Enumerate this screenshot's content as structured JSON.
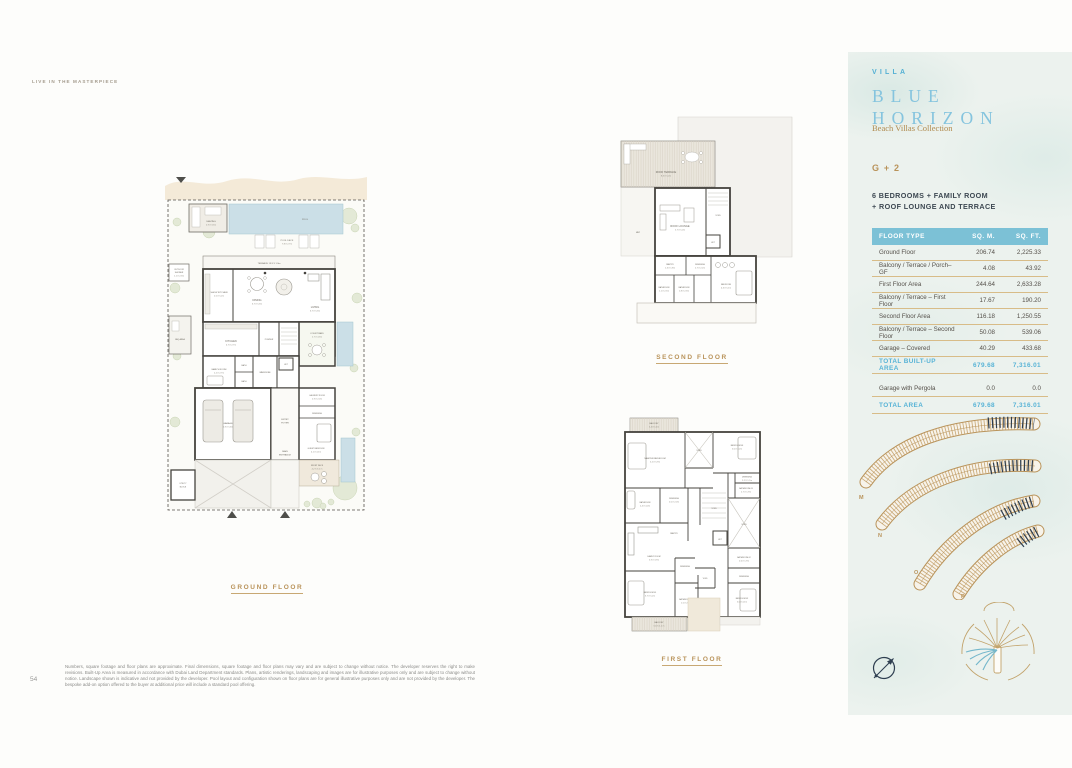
{
  "page": {
    "eyebrow": "LIVE IN THE MASTERPIECE",
    "page_number": "54",
    "disclaimer": "Numbers, square footage and floor plans are approximate. Final dimensions, square footage and floor plans may vary and are subject to change without notice. The developer reserves the right to make revisions. Built-Up Area is measured in accordance with Dubai Land Department standards. Plans, artistic renderings, landscaping and images are for illustrative purposes only and are subject to change without notice. Landscape shown is indicative and not provided by the developer. Pool layout and configuration shown on floor plans are for general illustrative purposes only and are not provided by the developer. The bespoke add-on option offered to the buyer at additional price will include a standard pool offering."
  },
  "plans": {
    "ground": {
      "caption": "GROUND FLOOR",
      "rooms": {
        "seating": "SEATING",
        "seating_dim": "2.9 X 3.5m",
        "pool": "POOL",
        "pool_deck": "POOL DECK",
        "pool_deck_dim": "7.8 X 2.7m",
        "terrace": "TERRACE 13.9 X 1.9m",
        "outdoor_shower_1": "OUTDOOR",
        "outdoor_shower_2": "SHOWER",
        "outdoor_shower_dim": "1.1 X 2.3m",
        "show_kitchen": "SHOW KITCHEN",
        "show_kitchen_dim": "2.5 X 5.2m",
        "dining": "DINING",
        "dining_dim": "6.7 X 5.3m",
        "living": "LIVING",
        "living_dim": "6.7 X 5.3m",
        "bbq": "BBQ AREA",
        "kitchen": "KITCHEN",
        "kitchen_dim": "4.7 X 2.7m",
        "powder": "POWDER",
        "courtyard": "COURTYARD",
        "courtyard_dim": "2.7 X 4.3m",
        "maids": "MAID'S ROOM",
        "maids_dim": "2.2 X 2.7m",
        "bath_a": "BATH",
        "bath_b": "BATH",
        "wardrobe": "WARDROBE",
        "lift": "LIFT",
        "garage": "GARAGE",
        "garage_dim": "5.9 X 5.6m",
        "entry_1": "ENTRY",
        "entry_2": "FOYER",
        "main_entrance_1": "MAIN",
        "main_entrance_2": "ENTRANCE",
        "laundry": "LAUNDRY ROOM",
        "laundry_dim": "2.9 X 2.0m",
        "dressing": "DRESSING",
        "guest_bedroom": "GUEST BEDROOM",
        "guest_bedroom_dim": "4.1 X 4.1m",
        "front_deck": "FRONT DECK",
        "front_deck_dim": "4.2 X 3.1 m",
        "utility_1": "UTILITY",
        "utility_2": "BLOCK"
      }
    },
    "second": {
      "caption": "SECOND FLOOR",
      "rooms": {
        "roof_terrace": "ROOF TERRACE",
        "roof_terrace_dim": "8.3 X 5.2m",
        "roof_lounge": "ROOF LOUNGE",
        "roof_lounge_dim": "5.7 X 5.0m",
        "void": "VOID",
        "lift": "LIFT",
        "mep": "MEP",
        "pantry": "PANTRY",
        "pantry_dim": "1.3 X 1.8m",
        "dressing": "DRESSING",
        "dressing_dim": "2.7 X 2.2m",
        "bathroom_a": "BATHROOM",
        "bathroom_a_dim": "1.1 X 2.5m",
        "bathroom_b": "BATHROOM",
        "bathroom_b_dim": "1.8 X 2.3m",
        "bedroom": "BEDROOM",
        "bedroom_dim": "4.3 X 5.1m"
      }
    },
    "first": {
      "caption": "FIRST FLOOR",
      "rooms": {
        "balcony_top": "BALCONY",
        "balcony_top_dim": "5.4 X 1.4m",
        "master": "MASTER BEDROOM",
        "master_dim": "5.2 X 5.9m",
        "void_top": "VOID",
        "bedroom03": "BEDROOM 03",
        "bedroom03_dim": "5.0 X 4.2m",
        "dressing03": "DRESSING",
        "dressing03_dim": "2.2 X 1.7m",
        "bathroom03": "BATHROOM 03",
        "bathroom03_dim": "2.7 X 1.9m",
        "bathroom_m": "BATHROOM",
        "bathroom_m_dim": "2.4 X 4.0m",
        "dressing_m": "DRESSING",
        "dressing_m_dim": "2.0 X 2.0m",
        "void_center": "VOID",
        "void_right": "VOID",
        "void_small": "VOID",
        "pantry": "PANTRY",
        "family": "FAMILY ROOM",
        "family_dim": "5.9 X 3.9m",
        "lift": "LIFT",
        "bathroom02": "BATHROOM 02",
        "bathroom02_dim": "2.6 X 1.9m",
        "dressing02": "DRESSING",
        "dressing01": "DRESSING",
        "bedroom01": "BEDROOM 01",
        "bedroom01_dim": "3.7 X 5.2m",
        "bathroom01": "BATHROOM 01",
        "bathroom01_dim": "1.5 X 2.9m",
        "bedroom02": "BEDROOM 02",
        "bedroom02_dim": "5.0 X 4.1m",
        "balcony_bottom": "BALCONY",
        "balcony_bottom_dim": "5.6 X 1.1 m"
      }
    }
  },
  "panel": {
    "villa_label": "VILLA",
    "name_line1": "BLUE",
    "name_line2": "HORIZON",
    "collection": "Beach Villas Collection",
    "configuration": "G + 2",
    "features_line1": "6 BEDROOMS + FAMILY ROOM",
    "features_line2": "+ ROOF LOUNGE AND TERRACE",
    "table": {
      "headers": {
        "type": "FLOOR TYPE",
        "sqm": "SQ. M.",
        "sqft": "SQ. FT."
      },
      "rows": [
        {
          "label": "Ground Floor",
          "sqm": "206.74",
          "sqft": "2,225.33"
        },
        {
          "label": "Balcony / Terrace / Porch– GF",
          "sqm": "4.08",
          "sqft": "43.92"
        },
        {
          "label": "First Floor Area",
          "sqm": "244.64",
          "sqft": "2,633.28"
        },
        {
          "label": "Balcony / Terrace – First Floor",
          "sqm": "17.67",
          "sqft": "190.20"
        },
        {
          "label": "Second Floor Area",
          "sqm": "116.18",
          "sqft": "1,250.55"
        },
        {
          "label": "Balcony / Terrace – Second Floor",
          "sqm": "50.08",
          "sqft": "539.06"
        },
        {
          "label": "Garage – Covered",
          "sqm": "40.29",
          "sqft": "433.68"
        }
      ],
      "total_built_up": {
        "label": "TOTAL BUILT-UP AREA",
        "sqm": "679.68",
        "sqft": "7,316.01"
      },
      "pergola": {
        "label": "Garage with Pergola",
        "sqm": "0.0",
        "sqft": "0.0"
      },
      "total_area": {
        "label": "TOTAL AREA",
        "sqm": "679.68",
        "sqft": "7,316.01"
      }
    },
    "fronds": [
      "M",
      "N",
      "O",
      "P"
    ]
  },
  "colors": {
    "accent_gold": "#b9935a",
    "accent_blue": "#57b3d6",
    "table_header_bg": "#7cc1d6",
    "navy": "#2e3e50",
    "pool_blue": "#cbdfe7",
    "beach_sand": "#f4ead8",
    "panel_bg": "#ecf2ee"
  }
}
